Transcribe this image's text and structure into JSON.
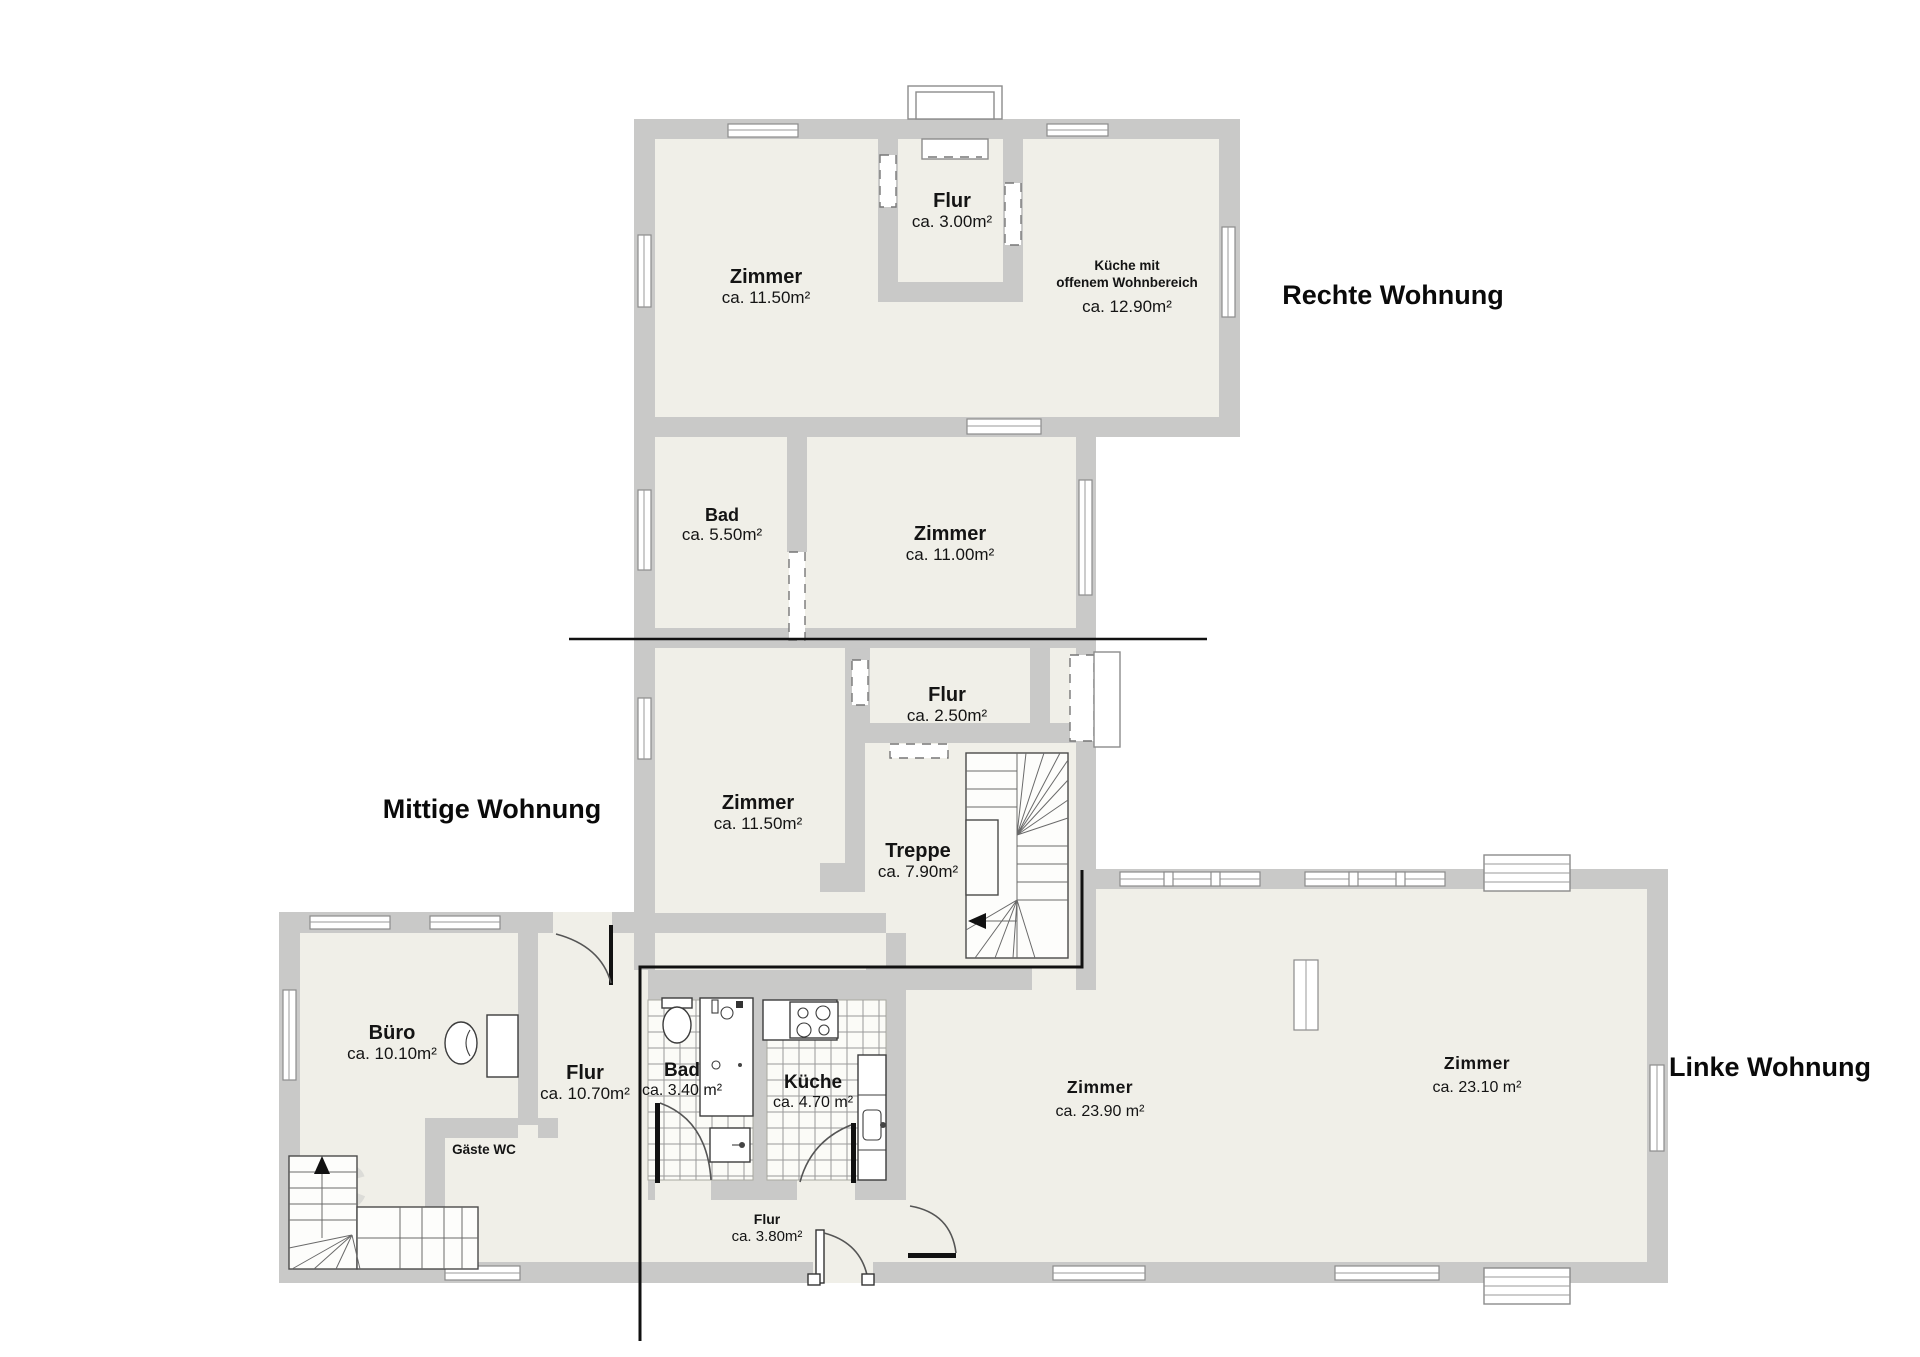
{
  "plan": {
    "apartment_labels": {
      "right": "Rechte Wohnung",
      "middle": "Mittige Wohnung",
      "left": "Linke Wohnung"
    },
    "rooms": {
      "zimmer_top": {
        "name": "Zimmer",
        "area": "ca. 11.50m²"
      },
      "flur_top": {
        "name": "Flur",
        "area": "ca. 3.00m²"
      },
      "kueche_open": {
        "name": "Küche mit",
        "name2": "offenem Wohnbereich",
        "area": "ca. 12.90m²"
      },
      "bad_top": {
        "name": "Bad",
        "area": "ca. 5.50m²"
      },
      "zimmer_11": {
        "name": "Zimmer",
        "area": "ca. 11.00m²"
      },
      "flur_mid": {
        "name": "Flur",
        "area": "ca. 2.50m²"
      },
      "zimmer_mid": {
        "name": "Zimmer",
        "area": "ca. 11.50m²"
      },
      "treppe": {
        "name": "Treppe",
        "area": "ca. 7.90m²"
      },
      "buero": {
        "name": "Büro",
        "area": "ca. 10.10m²"
      },
      "flur_wing": {
        "name": "Flur",
        "area": "ca. 10.70m²"
      },
      "gaeste_wc": {
        "name": "Gäste WC"
      },
      "bad_left": {
        "name": "Bad",
        "area": "ca. 3.40 m²"
      },
      "kueche_left": {
        "name": "Küche",
        "area": "ca. 4.70 m²"
      },
      "zimmer_2390": {
        "name": "Zimmer",
        "area": "ca. 23.90 m²"
      },
      "zimmer_2310": {
        "name": "Zimmer",
        "area": "ca. 23.10 m²"
      },
      "flur_entry": {
        "name": "Flur",
        "area": "ca. 3.80m²"
      }
    },
    "watermark": {
      "letter1": "C",
      "letter2": "I"
    },
    "colors": {
      "wall": "#c9c9c8",
      "floor": "#f0efe8",
      "divider": "#111111"
    }
  }
}
